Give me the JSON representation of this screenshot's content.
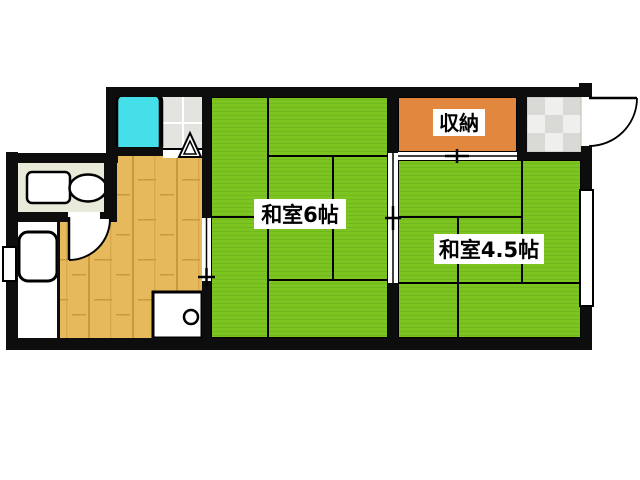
{
  "plan": {
    "type": "floor-plan",
    "rooms": {
      "washitsu6": {
        "label": "和室6帖"
      },
      "washitsu45": {
        "label": "和室4.5帖"
      },
      "closet": {
        "label": "収納"
      }
    },
    "colors": {
      "tatami_green": "#7CC521",
      "tatami_stripe": "#71B71D",
      "closet_orange": "#E2883E",
      "wood_floor": "#E6BA5C",
      "sink_cyan": "#45DFEA",
      "toilet_room_cream": "#EAEADA",
      "tile_gray": "#E3E3E0",
      "genkan_tile_dark": "#D9D9D6",
      "genkan_tile_light": "#EFEFED",
      "wall_black": "#0d0d0d",
      "background": "#ffffff"
    }
  }
}
